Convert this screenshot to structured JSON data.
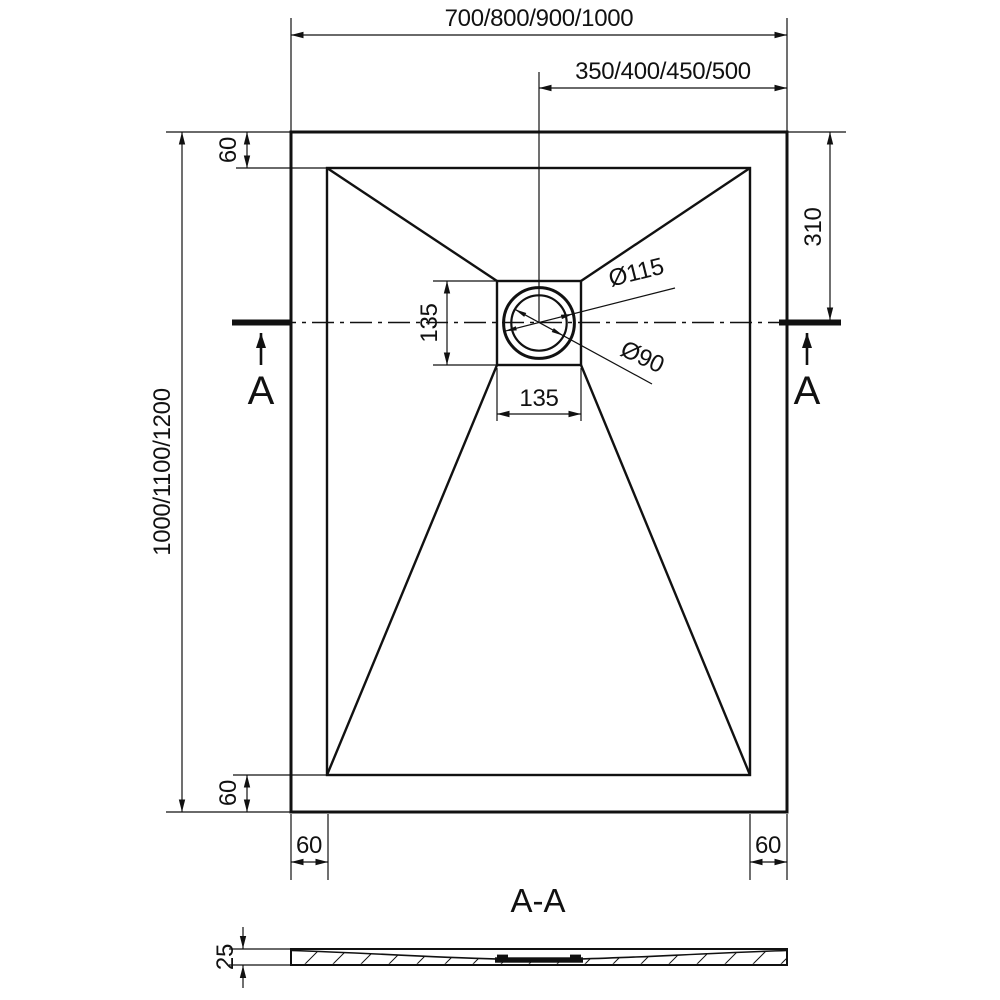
{
  "colors": {
    "line": "#111111",
    "background": "#ffffff"
  },
  "plan_view": {
    "dimensions": {
      "overall_width": "700/800/900/1000",
      "drain_offset": "350/400/450/500",
      "overall_length": "1000/1100/1200",
      "drain_from_top": "310",
      "border_top": "60",
      "border_bottom": "60",
      "border_bottom_left": "60",
      "border_bottom_right": "60",
      "drain_square_height": "135",
      "drain_square_width": "135",
      "flange_diameter": "Ø115",
      "drain_diameter": "Ø90"
    },
    "section_marks": {
      "left": "A",
      "right": "A"
    }
  },
  "section_view": {
    "title": "A-A",
    "dimensions": {
      "thickness": "25"
    }
  }
}
